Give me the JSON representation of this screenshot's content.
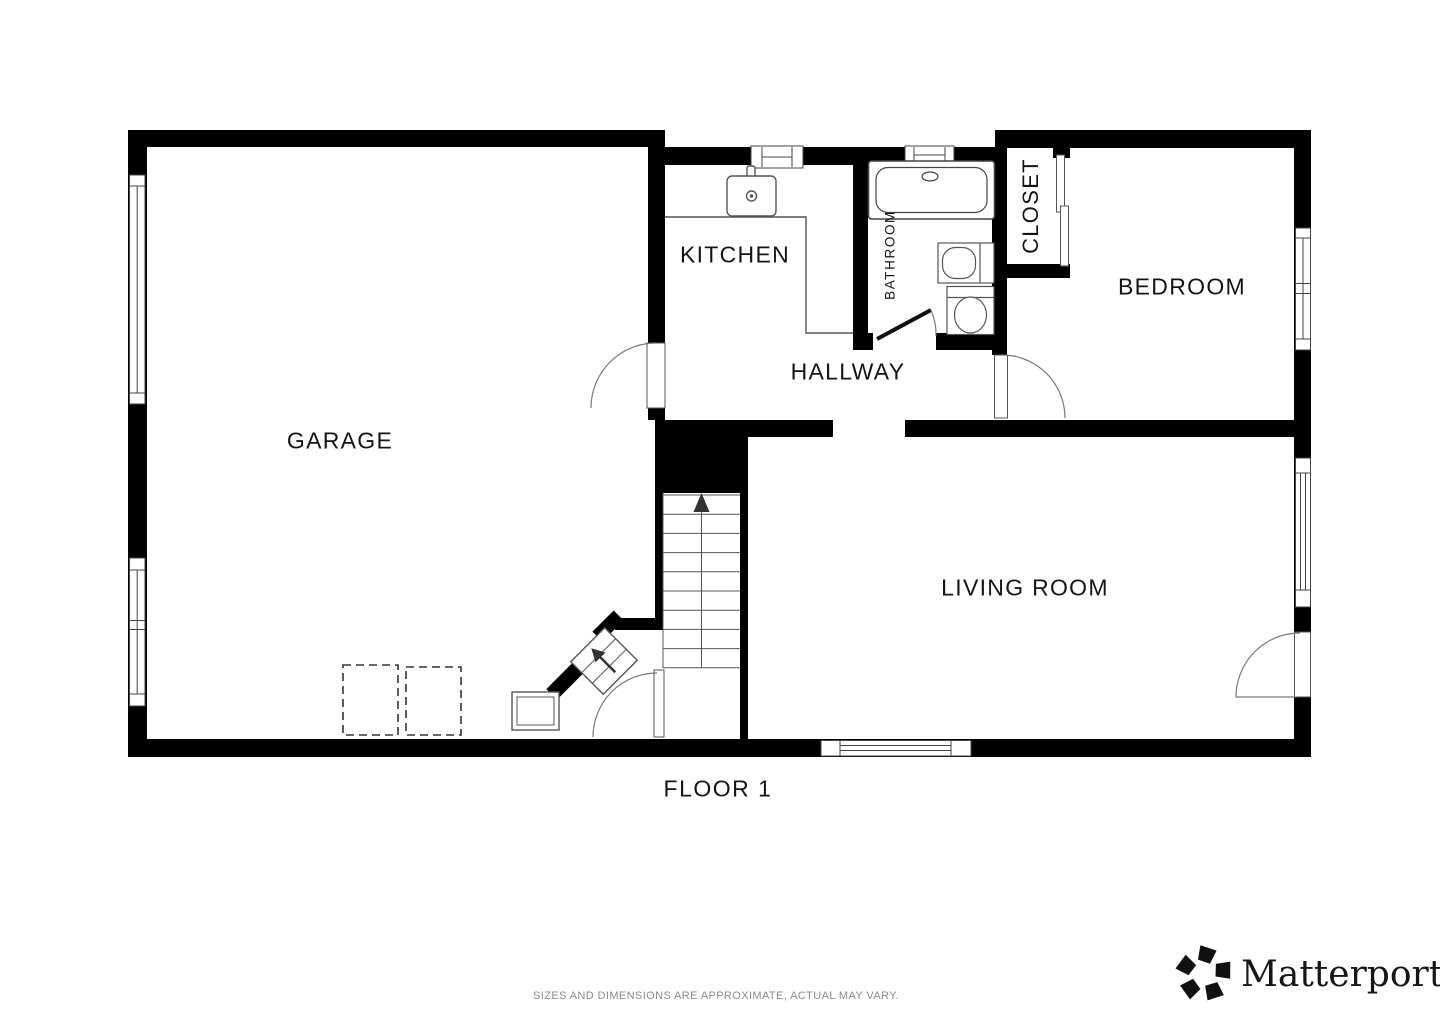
{
  "floor_plan": {
    "floor_label": "FLOOR 1",
    "rooms": [
      {
        "name": "garage",
        "label": "GARAGE"
      },
      {
        "name": "kitchen",
        "label": "KITCHEN"
      },
      {
        "name": "bathroom",
        "label": "BATHROOM"
      },
      {
        "name": "closet",
        "label": "CLOSET"
      },
      {
        "name": "bedroom",
        "label": "BEDROOM"
      },
      {
        "name": "hallway",
        "label": "HALLWAY"
      },
      {
        "name": "living_room",
        "label": "LIVING ROOM"
      }
    ]
  },
  "footer": {
    "disclaimer": "SIZES AND DIMENSIONS ARE APPROXIMATE, ACTUAL MAY VARY.",
    "brand_name": "Matterport",
    "registered_mark": "®"
  },
  "colors": {
    "wall": "#000000",
    "fixture_line": "#555555",
    "door_arc": "#777777",
    "label_text": "#141414",
    "muted_text": "#8a8a8a"
  }
}
